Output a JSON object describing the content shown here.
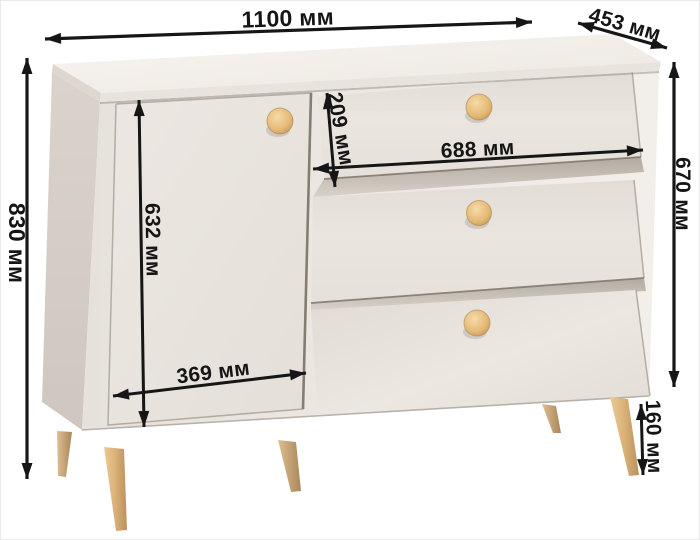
{
  "diagram": {
    "kind": "furniture-dimension-diagram",
    "units": "мм",
    "dimensions": {
      "width": {
        "label": "1100 мм"
      },
      "depth": {
        "label": "453 мм"
      },
      "height": {
        "label": "830 мм"
      },
      "drawer_column_height": {
        "label": "670 мм"
      },
      "door_height": {
        "label": "632 мм"
      },
      "top_drawer_height": {
        "label": "209 мм"
      },
      "drawer_width": {
        "label": "688 мм"
      },
      "door_width": {
        "label": "369 мм"
      },
      "leg_height": {
        "label": "160 мм"
      }
    },
    "furniture": {
      "drawer_count": 3,
      "door_count": 1,
      "visible_legs": 5,
      "knob_count": 4
    },
    "colors": {
      "background": "#ffffff",
      "dimension_line": "#161616",
      "cabinet_front": "#e9e4df",
      "cabinet_top": "#f5f1ec",
      "cabinet_side": "#d8d1ca",
      "wood_knob": "#e7bf82",
      "wood_leg": "#d9b279"
    }
  }
}
